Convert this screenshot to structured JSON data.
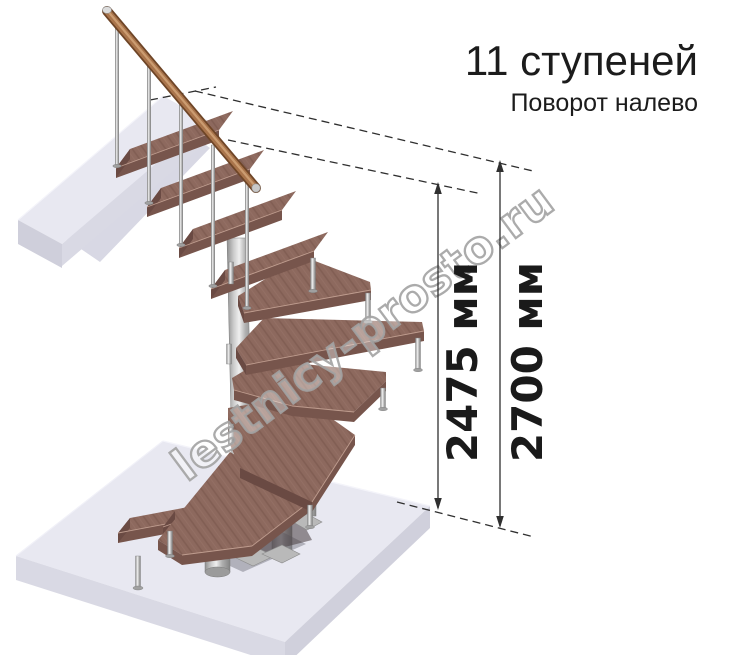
{
  "header": {
    "title": "11 ступеней",
    "subtitle": "Поворот налево"
  },
  "dimensions": {
    "inner": {
      "label": "2475 мм"
    },
    "outer": {
      "label": "2700 мм"
    }
  },
  "watermark": {
    "text": "lestnicy-prosto.ru"
  },
  "illustration": {
    "steps_count": 11,
    "turn_direction": "налево",
    "colors": {
      "background": "#ffffff",
      "wood_top": "#8d695e",
      "wood_front": "#77554c",
      "metal": "#b5b5b5",
      "handrail": "#a9744b",
      "slab": "#e8e8f1",
      "dimension_text": "#1a1a1a",
      "watermark_outline": "#a2a2a2"
    }
  }
}
